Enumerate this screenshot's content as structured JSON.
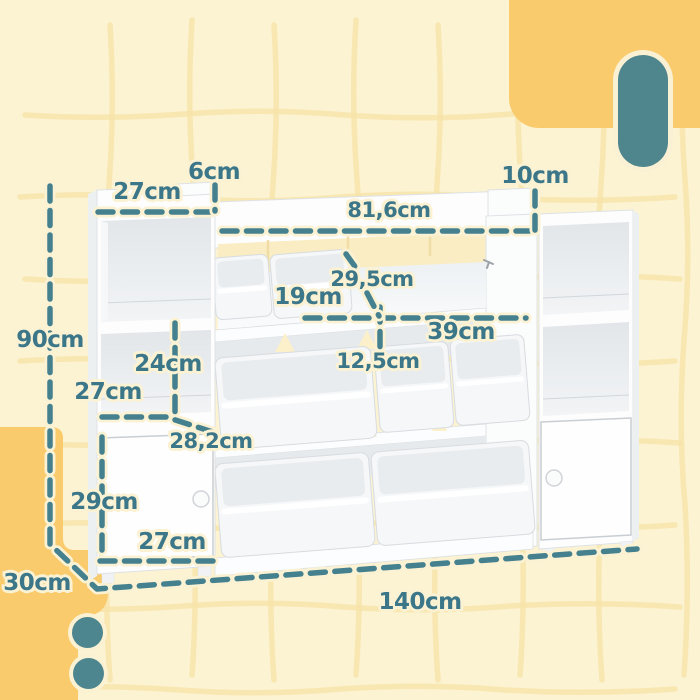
{
  "meta": {
    "type": "product-dimension-diagram",
    "subject": "white kids toy storage organizer with open cubbies, two doors and removable bins"
  },
  "palette": {
    "background_cream": "#FCF3D2",
    "accent_yellow": "#FACB6D",
    "teal_shape": "#4F858C",
    "dimension_teal": "#3B7689",
    "furniture_white": "#FDFDFE",
    "back_panel_cream": "#FAEDC3"
  },
  "decor": {
    "pill": "teal rounded pill, top right",
    "circles": "two teal dots, bottom left",
    "yellow_blocks": [
      "top-right rounded block",
      "bottom-left stepped block"
    ],
    "grid": "faint wavy hand-drawn grid"
  },
  "dimension_labels": [
    {
      "id": "left-top-width",
      "text": "27cm",
      "x": 147,
      "y": 192,
      "size": 23
    },
    {
      "id": "left-lip-height",
      "text": "6cm",
      "x": 214,
      "y": 172,
      "size": 23
    },
    {
      "id": "middle-top-width",
      "text": "81,6cm",
      "x": 389,
      "y": 210,
      "size": 21
    },
    {
      "id": "right-lip-height",
      "text": "10cm",
      "x": 535,
      "y": 176,
      "size": 23
    },
    {
      "id": "total-height",
      "text": "90cm",
      "x": 50,
      "y": 340,
      "size": 23
    },
    {
      "id": "slot-width",
      "text": "19cm",
      "x": 308,
      "y": 297,
      "size": 23
    },
    {
      "id": "slot-depth",
      "text": "29,5cm",
      "x": 372,
      "y": 279,
      "size": 21
    },
    {
      "id": "shelf-depth",
      "text": "39cm",
      "x": 461,
      "y": 332,
      "size": 23
    },
    {
      "id": "cubby-height",
      "text": "24cm",
      "x": 168,
      "y": 364,
      "size": 23
    },
    {
      "id": "front-lip-height",
      "text": "12,5cm",
      "x": 378,
      "y": 361,
      "size": 21
    },
    {
      "id": "cubby-width",
      "text": "27cm",
      "x": 108,
      "y": 392,
      "size": 23
    },
    {
      "id": "shelf-diagonal",
      "text": "28,2cm",
      "x": 211,
      "y": 441,
      "size": 21
    },
    {
      "id": "door-height",
      "text": "29cm",
      "x": 104,
      "y": 502,
      "size": 23
    },
    {
      "id": "door-width",
      "text": "27cm",
      "x": 172,
      "y": 542,
      "size": 23
    },
    {
      "id": "total-depth",
      "text": "30cm",
      "x": 37,
      "y": 583,
      "size": 23
    },
    {
      "id": "total-width",
      "text": "140cm",
      "x": 420,
      "y": 602,
      "size": 23
    }
  ]
}
